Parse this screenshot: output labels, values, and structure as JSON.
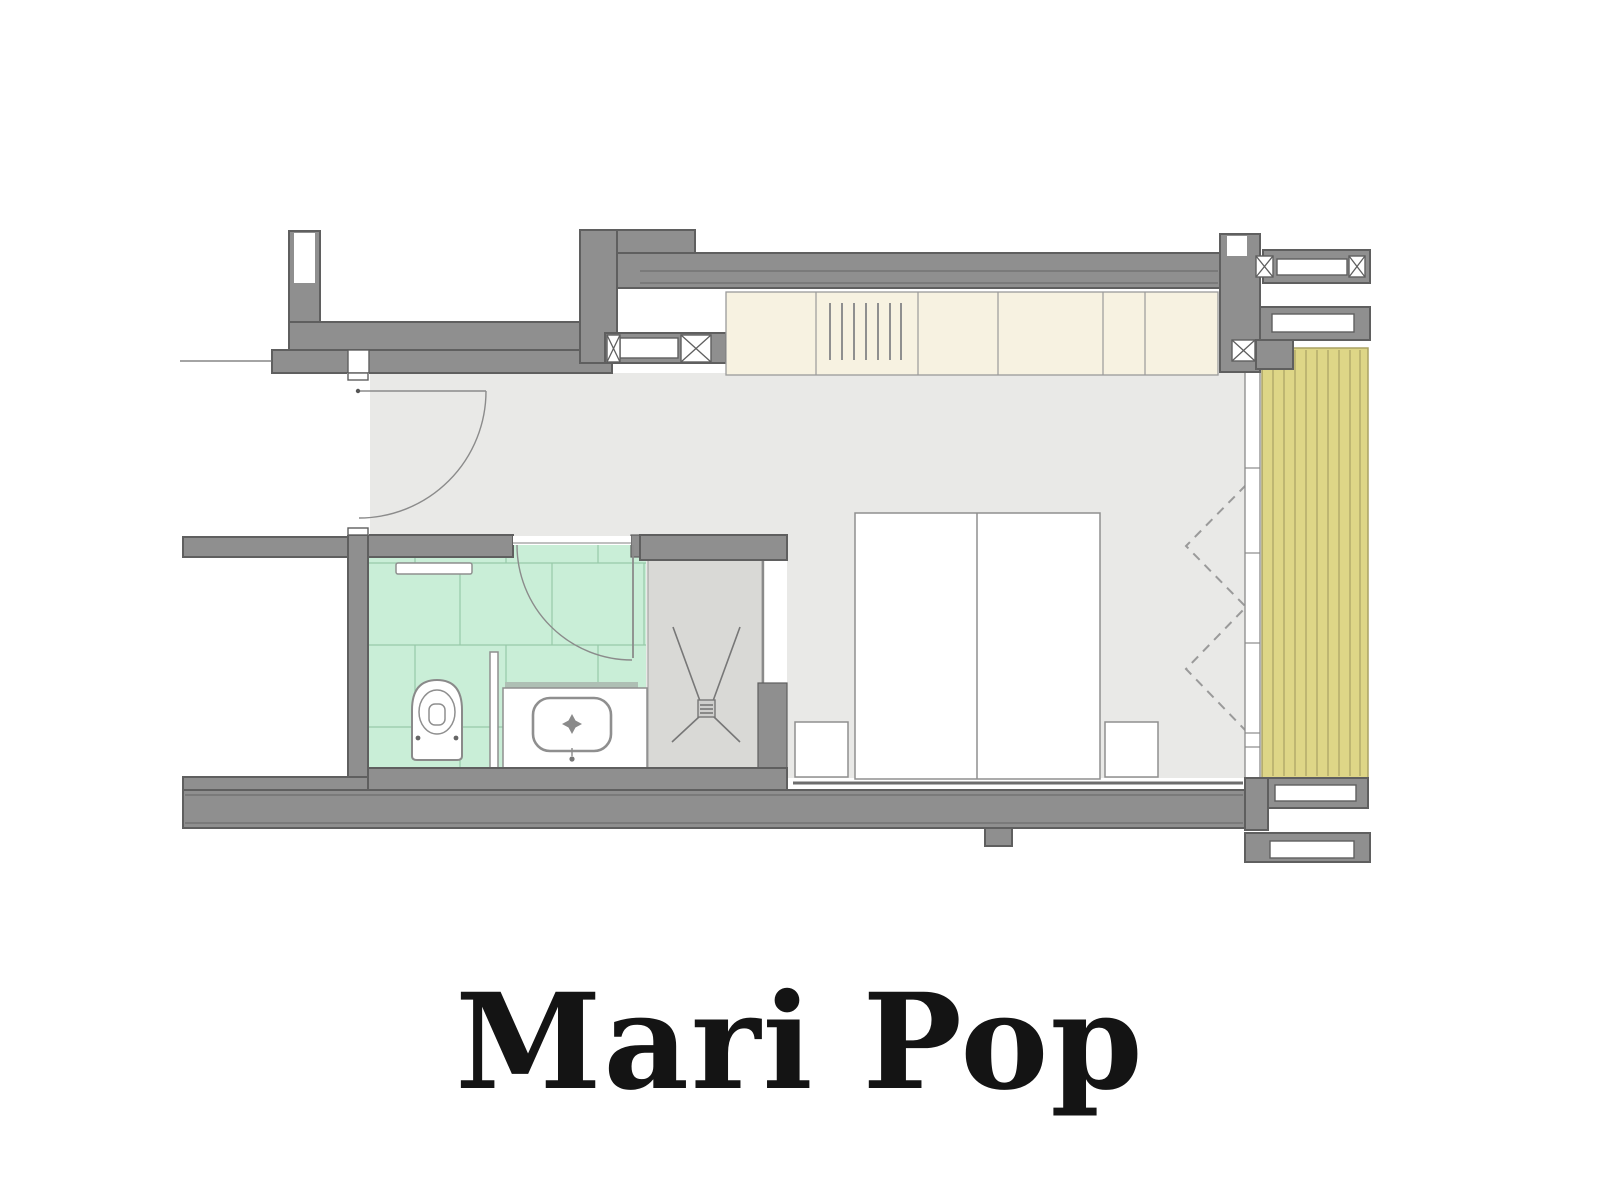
{
  "title": {
    "text": "Mari Pop"
  },
  "colors": {
    "bg": "#ffffff",
    "wall": "#8f8f8f",
    "wall_edge": "#5f5f5f",
    "floor": "#e9e9e7",
    "shower_floor": "#d9d9d6",
    "tile_green": "#c9eed7",
    "tile_line": "#97c9a8",
    "wardrobe": "#f7f2e1",
    "wardrobe_line": "#9a9a9a",
    "deck": "#ded687",
    "deck_line": "#aaa264",
    "title_color": "#141414"
  },
  "plan": {
    "rooms": [
      {
        "name": "entry-vestibule"
      },
      {
        "name": "bathroom"
      },
      {
        "name": "shower"
      },
      {
        "name": "bedroom"
      },
      {
        "name": "wardrobe"
      },
      {
        "name": "balcony-deck"
      },
      {
        "name": "corridor"
      }
    ],
    "fixtures": [
      {
        "name": "entry-door"
      },
      {
        "name": "bathroom-door"
      },
      {
        "name": "toilet"
      },
      {
        "name": "vanity-sink"
      },
      {
        "name": "towel-rail"
      },
      {
        "name": "shower-drain"
      },
      {
        "name": "double-bed"
      },
      {
        "name": "nightstand-left"
      },
      {
        "name": "nightstand-right"
      },
      {
        "name": "curtain"
      },
      {
        "name": "window"
      },
      {
        "name": "deck-planks"
      }
    ]
  }
}
